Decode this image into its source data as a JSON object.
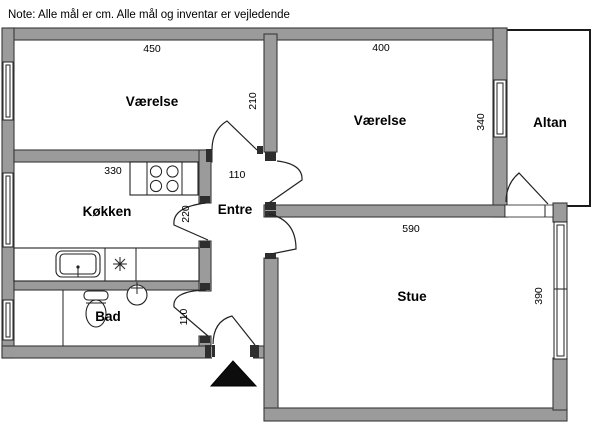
{
  "note": "Note: Alle mål er cm. Alle mål og inventar er vejledende",
  "rooms": {
    "bedroom1": {
      "label": "Værelse",
      "dim_width": "450",
      "dim_door": "110"
    },
    "bedroom2": {
      "label": "Værelse",
      "dim_width": "400",
      "dim_depth": "340"
    },
    "kitchen": {
      "label": "Køkken",
      "dim_width": "330",
      "dim_door": "220"
    },
    "hall": {
      "label": "Entre",
      "dim_depth": "210"
    },
    "bath": {
      "label": "Bad",
      "dim_door": "110"
    },
    "living": {
      "label": "Stue",
      "dim_width": "590",
      "dim_depth": "390"
    },
    "balcony": {
      "label": "Altan"
    }
  },
  "icons": {
    "stove": "stove-four-burners-icon",
    "kitchen_sink": "kitchen-sink-icon",
    "hob_symbol": "asterisk-hob-icon",
    "toilet": "toilet-icon",
    "washbasin": "washbasin-icon",
    "entrance_marker": "entrance-arrow-icon"
  },
  "colors": {
    "wall_fill": "#9b9b9b",
    "wall_outline": "#3a3a3a",
    "line": "#222222",
    "floor": "#ffffff",
    "text": "#000000"
  }
}
